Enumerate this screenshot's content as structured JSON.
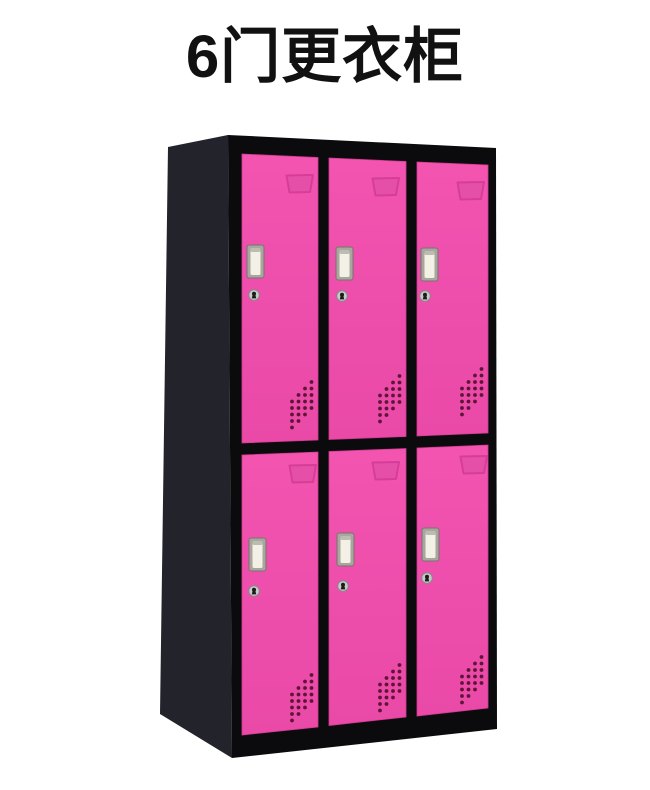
{
  "title": "6门更衣柜",
  "colors": {
    "page-bg": "#ffffff",
    "title-text": "#111111",
    "door-pink": "#ea49a7",
    "door-pink-light": "#f254b0",
    "door-pink-edge": "#d13a92",
    "frame-black": "#0b0b0d",
    "side-panel": "#23232b",
    "handle-frame": "#a9a69f",
    "handle-inset": "#f3f1e6",
    "lock-metal": "#c9c9c9",
    "lock-hole": "#1c1c1c",
    "vent-dot": "#5e1637"
  },
  "cabinet": {
    "description": "6-door steel locker, black frame with pink doors",
    "rows": 2,
    "columns": 3,
    "door_count": 6,
    "doors": [
      {
        "id": "row1-col1",
        "features": [
          "label-card-holder",
          "recessed-handle",
          "keyhole-lock",
          "ventilation-holes"
        ]
      },
      {
        "id": "row1-col2",
        "features": [
          "label-card-holder",
          "recessed-handle",
          "keyhole-lock",
          "ventilation-holes"
        ]
      },
      {
        "id": "row1-col3",
        "features": [
          "label-card-holder",
          "recessed-handle",
          "keyhole-lock",
          "ventilation-holes"
        ]
      },
      {
        "id": "row2-col1",
        "features": [
          "label-card-holder",
          "recessed-handle",
          "keyhole-lock",
          "ventilation-holes"
        ]
      },
      {
        "id": "row2-col2",
        "features": [
          "label-card-holder",
          "recessed-handle",
          "keyhole-lock",
          "ventilation-holes"
        ]
      },
      {
        "id": "row2-col3",
        "features": [
          "label-card-holder",
          "recessed-handle",
          "keyhole-lock",
          "ventilation-holes"
        ]
      }
    ]
  }
}
